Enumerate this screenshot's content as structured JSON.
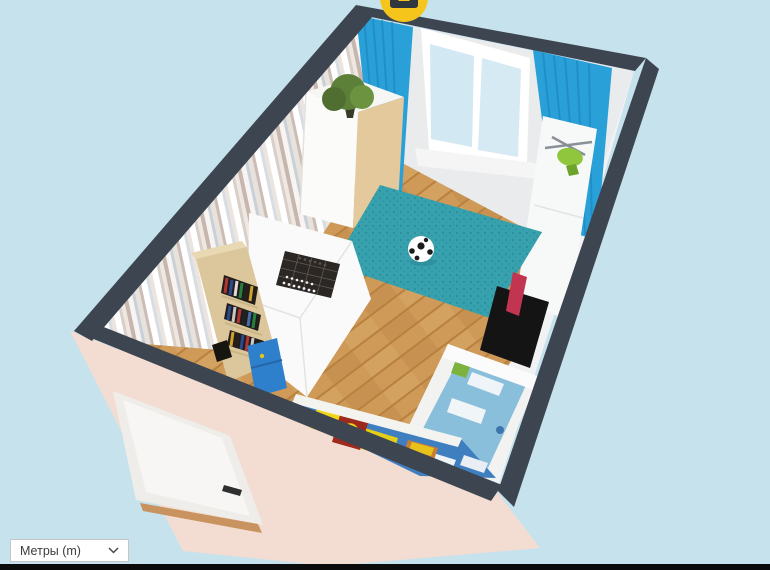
{
  "canvas": {
    "width": 770,
    "height": 570
  },
  "units_select": {
    "value": "Метры (m)",
    "chevron_icon": "chevron-down"
  },
  "camera_marker": {
    "icon": "camera",
    "shape": "yellow circle with dark camera body, top edge of canvas"
  },
  "colors": {
    "background": "#c6e2ec",
    "bottom_bar": "#0b0b0b",
    "wall_edge": "#3d4551",
    "wall_exterior_pink": "#f3ddd2",
    "wall_back": "#e9ebec",
    "wall_right": "#f0f2f3",
    "floor_plank": "#cf9a58",
    "floor_gap": "#b8803f",
    "rug_teal": "#37a1ae",
    "rug_speckle": "#2d8e9b",
    "curtain_blue": "#2aa0d9",
    "curtain_fold": "#1d86bd",
    "window_glass": "#d2e8f2",
    "window_frame": "#ffffff",
    "door_white": "#f7f6f4",
    "threshold_wood": "#c9935f",
    "wardrobe_front": "#fbfbfa",
    "wardrobe_side_wood": "#e3c99b",
    "bookshelf_wood": "#dcc69c",
    "drawer_blue": "#2f80cc",
    "knob_yellow": "#e8c21a",
    "desk_white": "#fafafa",
    "chessboard_dark": "#2b2724",
    "cabinet_white": "#f7f8f8",
    "toy_green": "#8fc63e",
    "rotor_gray": "#8a9097",
    "accent_red": "#c23550",
    "table_black": "#141414",
    "bed_frame": "#f2f3f1",
    "bedding_blue": "#8abfdc",
    "mat_blue": "#3f7fc0",
    "mat_yellow": "#f0d616",
    "mat_red": "#9e2a1e",
    "plant_green": "#5d8038",
    "camera_yellow": "#f5c51c",
    "camera_body": "#30363d",
    "ball_white": "#ffffff"
  },
  "scene": {
    "objects": [
      "striped wallpaper wall",
      "window wall",
      "white side wall",
      "pink exterior wall",
      "white entry door",
      "wood plank floor",
      "teal rug",
      "soccer ball",
      "wardrobe with plant on top",
      "potted plant",
      "blue curtains",
      "window with two panes",
      "white desk",
      "chess board with pieces",
      "bookshelf with books",
      "blue drawers",
      "white cabinet",
      "toy helicopter",
      "black table",
      "red chair",
      "kids bed with blue bedding",
      "colorful play mat with toys",
      "camera viewpoint marker"
    ]
  }
}
